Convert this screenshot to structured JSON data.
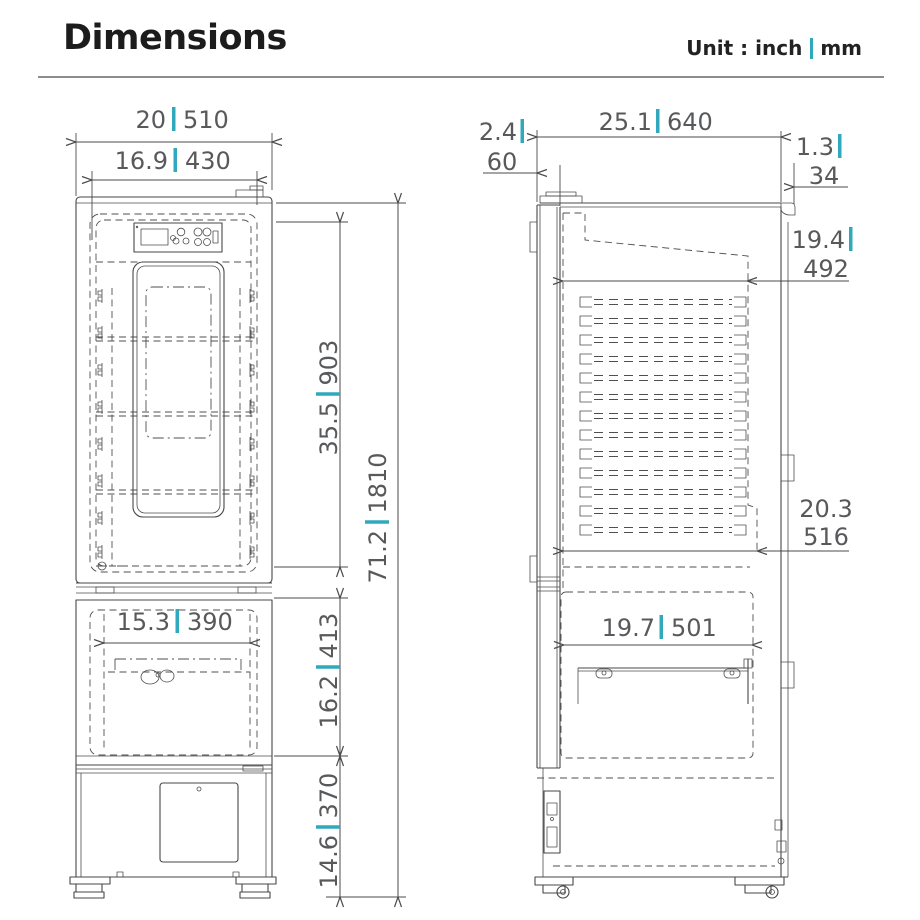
{
  "header": {
    "title": "Dimensions",
    "unit_prefix": "Unit : inch",
    "unit_mm": "mm"
  },
  "front_view": {
    "overall_width": {
      "inch": "20",
      "mm": "510"
    },
    "interior_width": {
      "inch": "16.9",
      "mm": "430"
    },
    "upper_chamber_height": {
      "inch": "35.5",
      "mm": "903"
    },
    "overall_height": {
      "inch": "71.2",
      "mm": "1810"
    },
    "middle_chamber_width": {
      "inch": "15.3",
      "mm": "390"
    },
    "middle_chamber_height": {
      "inch": "16.2",
      "mm": "413"
    },
    "base_height": {
      "inch": "14.6",
      "mm": "370"
    }
  },
  "side_view": {
    "door_thickness": {
      "inch": "2.4",
      "mm": "60"
    },
    "overall_depth": {
      "inch": "25.1",
      "mm": "640"
    },
    "wall_clearance": {
      "inch": "1.3",
      "mm": "34"
    },
    "upper_interior_depth": {
      "inch": "19.4",
      "mm": "492"
    },
    "lower_interior_depth": {
      "inch": "20.3",
      "mm": "516"
    },
    "middle_interior_depth": {
      "inch": "19.7",
      "mm": "501"
    }
  },
  "colors": {
    "accent": "#31a9bd",
    "line": "#474747",
    "dim_text": "#58595b",
    "title": "#1c1c1c"
  }
}
